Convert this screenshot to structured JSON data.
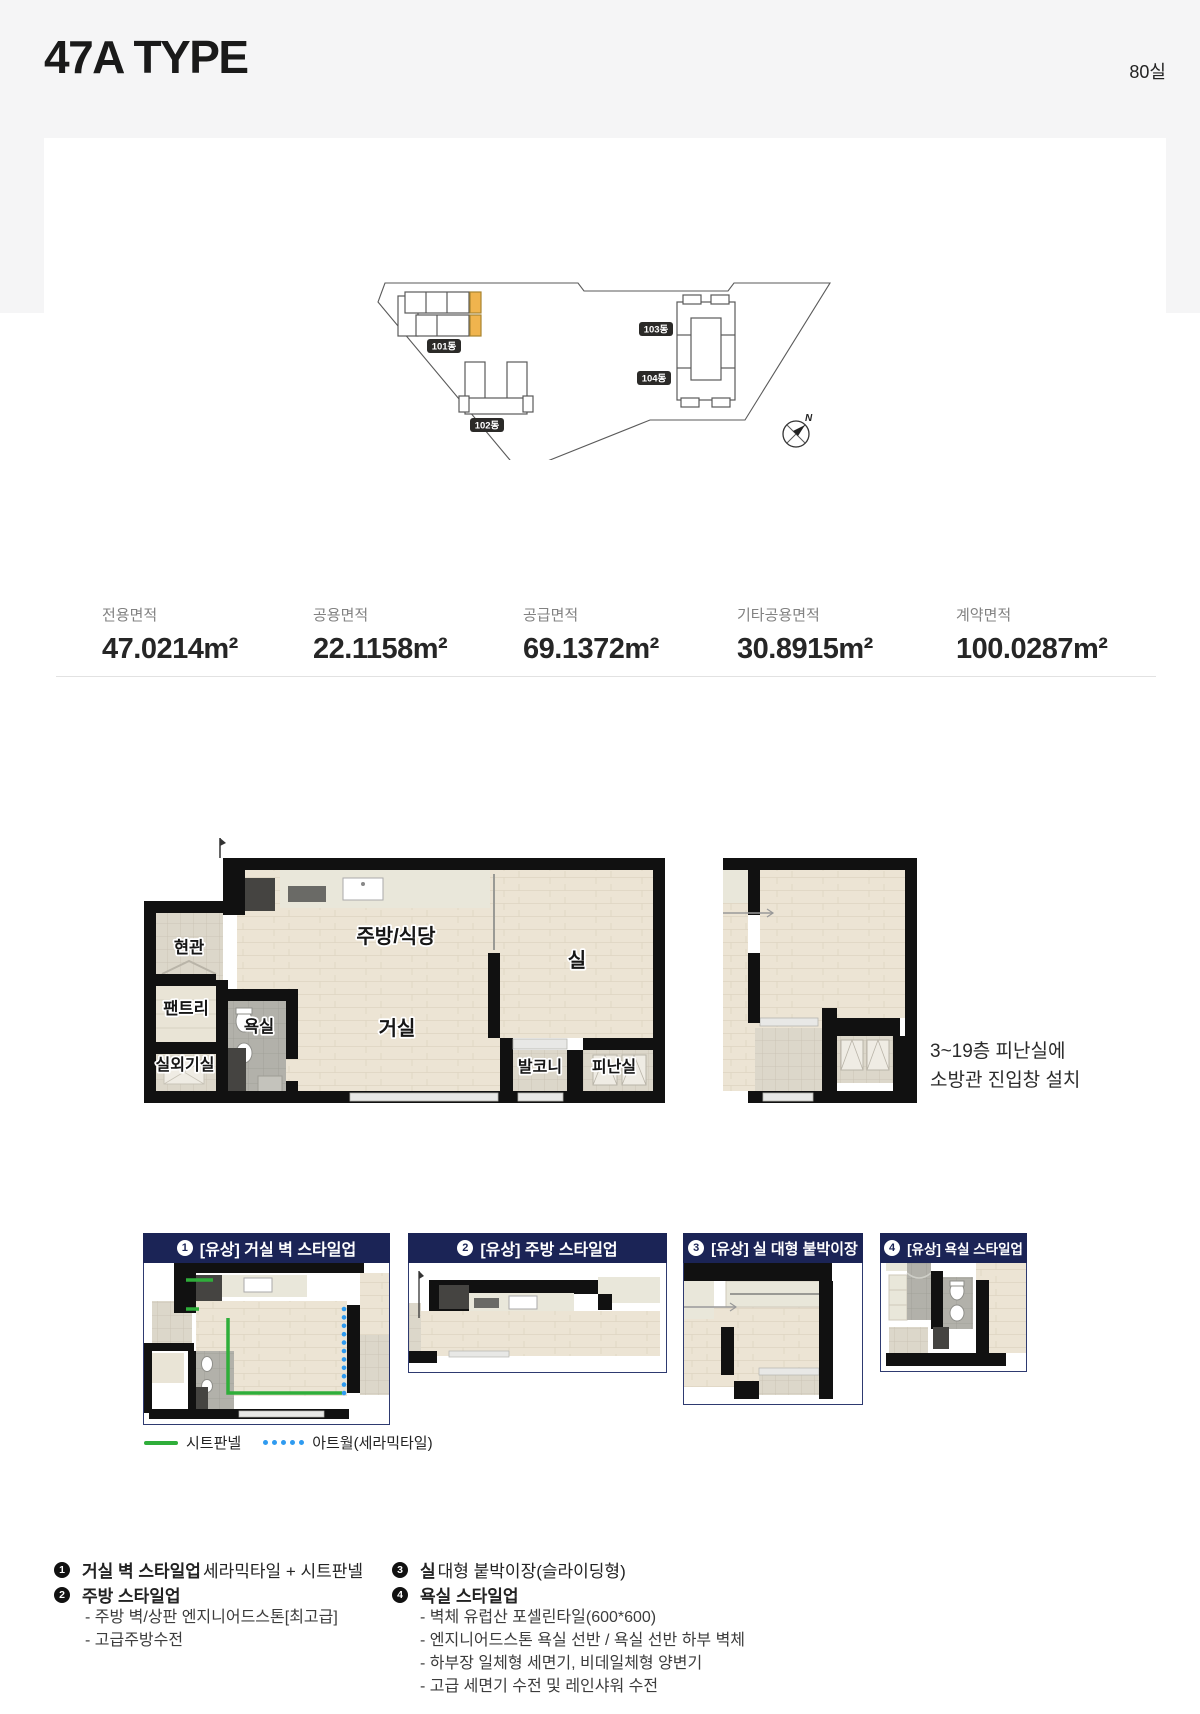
{
  "page": {
    "title": "47A TYPE",
    "unit_count": "80실"
  },
  "colors": {
    "accent_navy": "#1b2456",
    "highlight_orange": "#f0b44e",
    "legend_green": "#2fae3a",
    "legend_blue": "#2f9bf0",
    "band_gray": "#f5f5f6"
  },
  "site_plan": {
    "b101": "101동",
    "b102": "102동",
    "b103": "103동",
    "b104": "104동",
    "north": "N"
  },
  "areas": {
    "items": [
      {
        "label": "전용면적",
        "value": "47.0214m²"
      },
      {
        "label": "공용면적",
        "value": "22.1158m²"
      },
      {
        "label": "공급면적",
        "value": "69.1372m²"
      },
      {
        "label": "기타공용면적",
        "value": "30.8915m²"
      },
      {
        "label": "계약면적",
        "value": "100.0287m²"
      }
    ]
  },
  "floor_plan": {
    "rooms": {
      "entrance": "현관",
      "pantry": "팬트리",
      "ac_room": "실외기실",
      "bath": "욕실",
      "kitchen": "주방/식당",
      "living": "거실",
      "room": "실",
      "balcony": "발코니",
      "refuge": "피난실"
    },
    "refuge_note_line1": "3~19층 피난실에",
    "refuge_note_line2": "소방관 진입창 설치"
  },
  "style_panels": [
    {
      "num": "1",
      "title": "[유상] 거실 벽 스타일업"
    },
    {
      "num": "2",
      "title": "[유상] 주방 스타일업"
    },
    {
      "num": "3",
      "title": "[유상] 실 대형 붙박이장"
    },
    {
      "num": "4",
      "title": "[유상] 욕실 스타일업"
    }
  ],
  "legend": {
    "sheet_panel": "시트판넬",
    "artwall": "아트월(세라믹타일)"
  },
  "notes": {
    "n1": {
      "num": "1",
      "bold": "거실 벽 스타일업",
      "rest": "세라믹타일 + 시트판넬"
    },
    "n2": {
      "num": "2",
      "bold": "주방 스타일업",
      "rest": ""
    },
    "n2_subs": [
      "- 주방 벽/상판 엔지니어드스톤[최고급]",
      "- 고급주방수전"
    ],
    "n3": {
      "num": "3",
      "bold": "실",
      "rest": "대형 붙박이장(슬라이딩형)"
    },
    "n4": {
      "num": "4",
      "bold": "욕실 스타일업",
      "rest": ""
    },
    "n4_subs": [
      "- 벽체 유럽산 포셀린타일(600*600)",
      "- 엔지니어드스톤 욕실 선반 / 욕실 선반 하부 벽체",
      "- 하부장 일체형 세면기, 비데일체형 양변기",
      "- 고급 세면기 수전 및 레인샤워 수전"
    ]
  }
}
